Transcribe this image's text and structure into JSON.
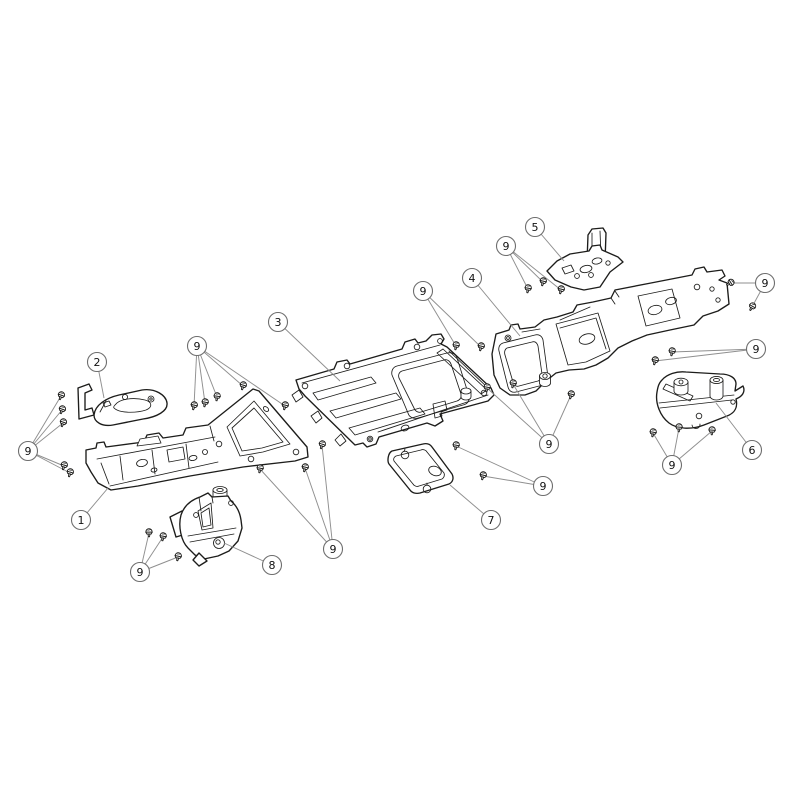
{
  "diagram": {
    "type": "exploded-parts-illustration",
    "colors": {
      "background": "#ffffff",
      "outline": "#1d1d1b",
      "leader": "#8f8f8f",
      "callout_stroke": "#6e6e6e",
      "callout_fill": "#ffffff",
      "callout_text": "#111111"
    },
    "callout_radius": 9.5,
    "callouts": [
      {
        "label": "1",
        "x": 81,
        "y": 520,
        "targets": [
          [
            108,
            488
          ]
        ]
      },
      {
        "label": "2",
        "x": 97,
        "y": 362,
        "targets": [
          [
            104,
            398
          ]
        ]
      },
      {
        "label": "3",
        "x": 278,
        "y": 322,
        "targets": [
          [
            340,
            381
          ]
        ]
      },
      {
        "label": "4",
        "x": 472,
        "y": 278,
        "targets": [
          [
            520,
            336
          ]
        ]
      },
      {
        "label": "5",
        "x": 535,
        "y": 227,
        "targets": [
          [
            564,
            261
          ]
        ]
      },
      {
        "label": "6",
        "x": 752,
        "y": 450,
        "targets": [
          [
            716,
            403
          ]
        ]
      },
      {
        "label": "7",
        "x": 491,
        "y": 520,
        "targets": [
          [
            450,
            485
          ]
        ]
      },
      {
        "label": "8",
        "x": 272,
        "y": 565,
        "targets": [
          [
            224,
            543
          ]
        ]
      },
      {
        "label": "9",
        "x": 197,
        "y": 346,
        "targets": [
          [
            194,
            406
          ],
          [
            205,
            403
          ],
          [
            217,
            397
          ],
          [
            243,
            386
          ],
          [
            285,
            406
          ]
        ]
      },
      {
        "label": "9",
        "x": 28,
        "y": 451,
        "targets": [
          [
            61,
            396
          ],
          [
            62,
            410
          ],
          [
            63,
            423
          ],
          [
            64,
            466
          ],
          [
            70,
            473
          ]
        ]
      },
      {
        "label": "9",
        "x": 140,
        "y": 572,
        "targets": [
          [
            149,
            533
          ],
          [
            163,
            537
          ],
          [
            178,
            557
          ]
        ]
      },
      {
        "label": "9",
        "x": 333,
        "y": 549,
        "targets": [
          [
            260,
            469
          ],
          [
            305,
            468
          ],
          [
            322,
            445
          ]
        ]
      },
      {
        "label": "9",
        "x": 506,
        "y": 246,
        "targets": [
          [
            528,
            289
          ],
          [
            543,
            282
          ],
          [
            561,
            290
          ]
        ]
      },
      {
        "label": "9",
        "x": 423,
        "y": 291,
        "targets": [
          [
            456,
            346
          ],
          [
            481,
            347
          ]
        ]
      },
      {
        "label": "9",
        "x": 765,
        "y": 283,
        "targets": [
          [
            730,
            283
          ],
          [
            752,
            307
          ]
        ]
      },
      {
        "label": "9",
        "x": 756,
        "y": 349,
        "targets": [
          [
            672,
            352
          ],
          [
            655,
            361
          ]
        ]
      },
      {
        "label": "9",
        "x": 549,
        "y": 444,
        "targets": [
          [
            513,
            384
          ],
          [
            487,
            388
          ],
          [
            571,
            395
          ]
        ]
      },
      {
        "label": "9",
        "x": 672,
        "y": 465,
        "targets": [
          [
            653,
            433
          ],
          [
            679,
            428
          ],
          [
            712,
            431
          ]
        ]
      },
      {
        "label": "9",
        "x": 543,
        "y": 486,
        "targets": [
          [
            456,
            446
          ],
          [
            483,
            476
          ]
        ]
      }
    ],
    "screws": [
      {
        "x": 194,
        "y": 406,
        "a": 14
      },
      {
        "x": 205,
        "y": 403,
        "a": 10
      },
      {
        "x": 217,
        "y": 397,
        "a": 8
      },
      {
        "x": 243,
        "y": 386,
        "a": 16
      },
      {
        "x": 285,
        "y": 406,
        "a": 14
      },
      {
        "x": 61,
        "y": 396,
        "a": 20
      },
      {
        "x": 62,
        "y": 410,
        "a": 20
      },
      {
        "x": 63,
        "y": 423,
        "a": 20
      },
      {
        "x": 64,
        "y": 466,
        "a": 16
      },
      {
        "x": 70,
        "y": 473,
        "a": 16
      },
      {
        "x": 149,
        "y": 533,
        "a": 0
      },
      {
        "x": 163,
        "y": 537,
        "a": 10
      },
      {
        "x": 178,
        "y": 557,
        "a": 12
      },
      {
        "x": 260,
        "y": 469,
        "a": 10
      },
      {
        "x": 305,
        "y": 468,
        "a": 14
      },
      {
        "x": 322,
        "y": 445,
        "a": 18
      },
      {
        "x": 528,
        "y": 289,
        "a": 10
      },
      {
        "x": 543,
        "y": 282,
        "a": 14
      },
      {
        "x": 561,
        "y": 290,
        "a": 14
      },
      {
        "x": 456,
        "y": 346,
        "a": 10
      },
      {
        "x": 481,
        "y": 347,
        "a": 14
      },
      {
        "x": 730,
        "y": 283,
        "a": 58
      },
      {
        "x": 752,
        "y": 307,
        "a": 30
      },
      {
        "x": 672,
        "y": 352,
        "a": 10
      },
      {
        "x": 655,
        "y": 361,
        "a": 14
      },
      {
        "x": 513,
        "y": 384,
        "a": 10
      },
      {
        "x": 487,
        "y": 388,
        "a": 10
      },
      {
        "x": 571,
        "y": 395,
        "a": 14
      },
      {
        "x": 653,
        "y": 433,
        "a": 10
      },
      {
        "x": 679,
        "y": 428,
        "a": 4
      },
      {
        "x": 712,
        "y": 431,
        "a": 4
      },
      {
        "x": 456,
        "y": 446,
        "a": 10
      },
      {
        "x": 483,
        "y": 476,
        "a": 14
      }
    ]
  }
}
